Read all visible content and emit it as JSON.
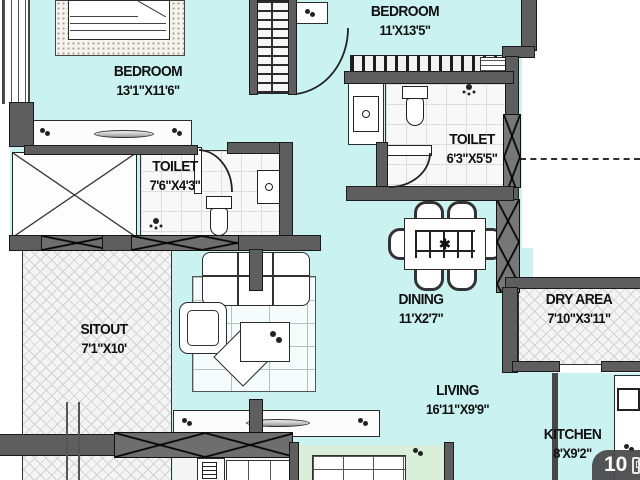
{
  "title": "Apartment floor plan",
  "colors": {
    "floor": "#c9f2f1",
    "floor_secondary": "#d9efd9",
    "wall": "#5e5e5e",
    "outside": "#ffffff",
    "badge_bg": "#484848"
  },
  "rooms": {
    "bedroom1": {
      "name": "BEDROOM",
      "dims": "13'1\"X11'6\""
    },
    "bedroom2": {
      "name": "BEDROOM",
      "dims": "11'X13'5\""
    },
    "toilet1": {
      "name": "TOILET",
      "dims": "7'6\"X4'3\""
    },
    "toilet2": {
      "name": "TOILET",
      "dims": "6'3\"X5'5\""
    },
    "dining": {
      "name": "DINING",
      "dims": "11'X2'7\""
    },
    "dry_area": {
      "name": "DRY AREA",
      "dims": "7'10\"X3'11\""
    },
    "sitout": {
      "name": "SITOUT",
      "dims": "7'1\"X10'"
    },
    "living": {
      "name": "LIVING",
      "dims": "16'11\"X9'9\""
    },
    "kitchen": {
      "name": "KITCHEN",
      "dims": "8'X9'2\""
    }
  },
  "icons": {
    "dining_table_center": "✱"
  },
  "badge": {
    "count": "10"
  }
}
